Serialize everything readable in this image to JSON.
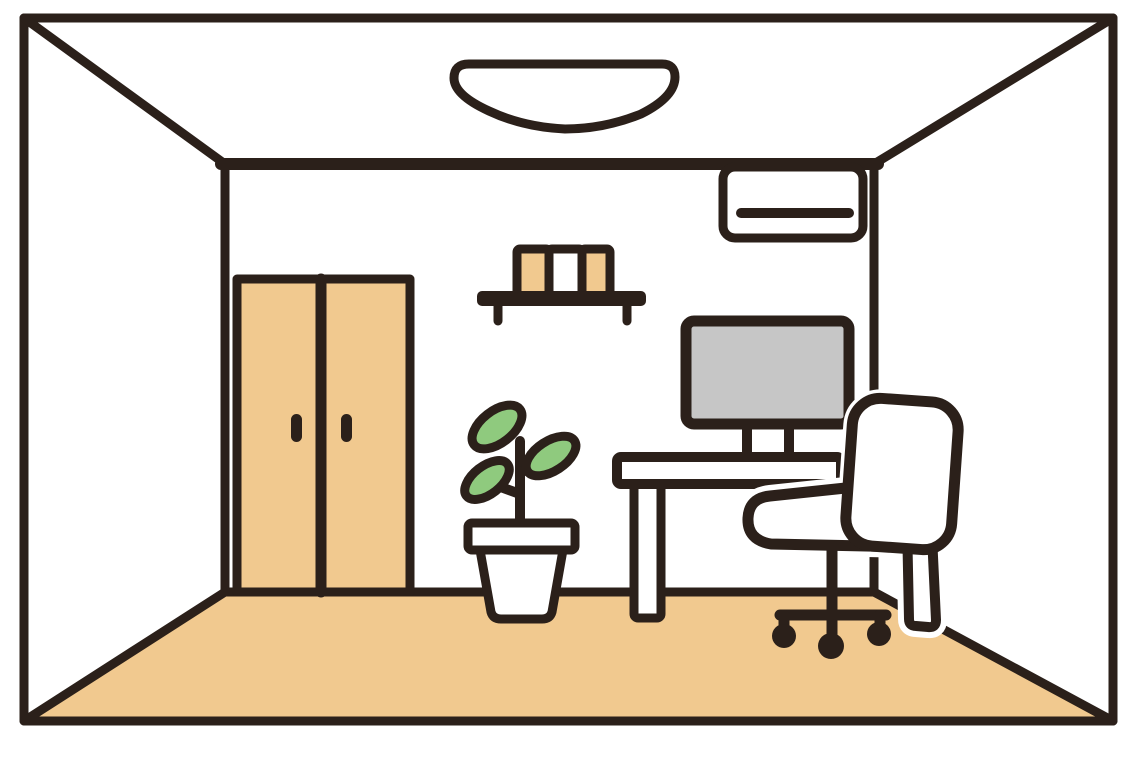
{
  "scene": {
    "title": "Flat illustration of a room interior in one-point perspective",
    "style": "thick dark outlines, flat fills, clip-art style"
  },
  "colors": {
    "outline": "#2b201a",
    "white": "#ffffff",
    "wood": "#f1c98f",
    "leaf": "#8fca7e",
    "screen": "#c6c6c6"
  },
  "objects": [
    {
      "id": "room-frame",
      "label": "room walls in perspective"
    },
    {
      "id": "floor",
      "label": "wooden floor"
    },
    {
      "id": "ceiling-light",
      "label": "ceiling light"
    },
    {
      "id": "air-conditioner",
      "label": "wall mounted air conditioner"
    },
    {
      "id": "wall-shelf",
      "label": "wall shelf with three books"
    },
    {
      "id": "closet",
      "label": "two-door closet"
    },
    {
      "id": "potted-plant",
      "label": "potted plant with three leaves"
    },
    {
      "id": "desk",
      "label": "computer desk"
    },
    {
      "id": "monitor",
      "label": "desktop monitor"
    },
    {
      "id": "office-chair",
      "label": "office swivel chair with casters"
    }
  ]
}
